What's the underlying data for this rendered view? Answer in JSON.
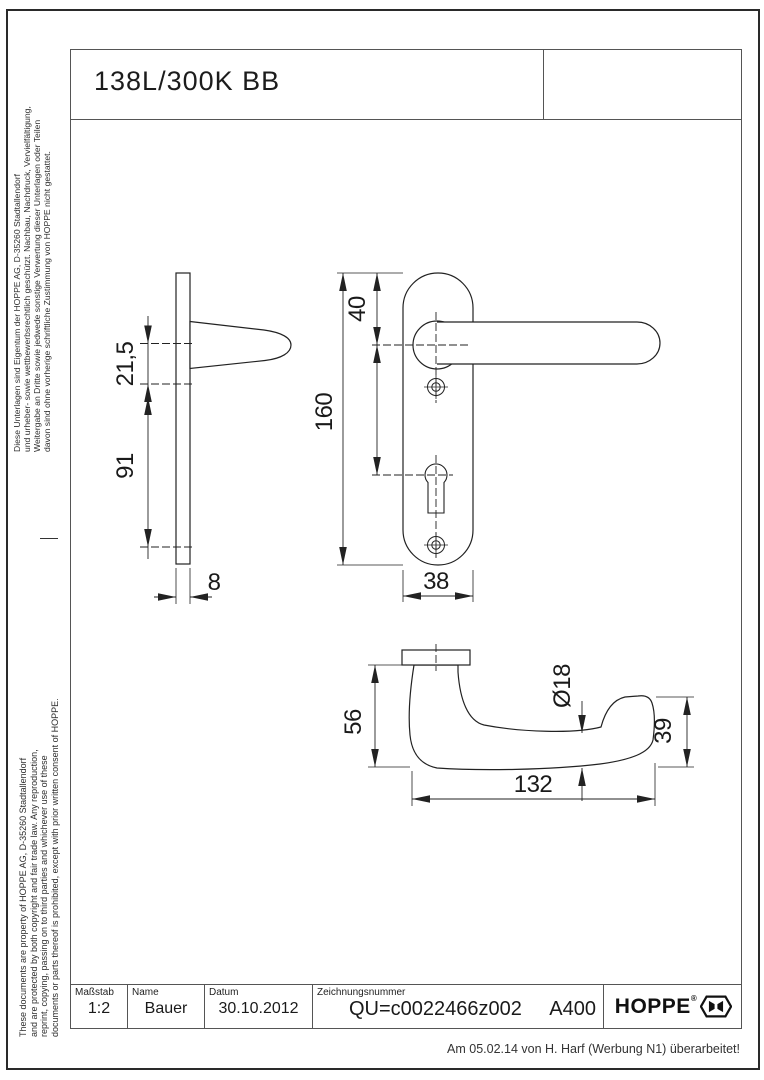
{
  "page": {
    "title": "138L/300K BB",
    "revision_note": "Am 05.02.14 von H. Harf (Werbung N1) überarbeitet!"
  },
  "legal": {
    "german": [
      "Diese Unterlagen sind Eigentum der HOPPE AG, D-35260 Stadtallendorf",
      "und urheber- sowie wettbewerbsrechtlich geschützt. Nachbau, Nachdruck, Vervielfältigung,",
      "Weitergabe an Dritte sowie jedwede sonstige Verwertung dieser Unterlagen oder Teilen",
      "davon sind ohne vorherige schriftliche Zustimmung von HOPPE nicht gestattet."
    ],
    "english": [
      "These documents are property of HOPPE AG, D-35260 Stadtallendorf",
      "and are protected by both copyright and fair trade law. Any reproduction,",
      "reprint, copying, passing on to third parties and whichever use of these",
      "documents or parts thereof is prohibited, except with prior written consent of HOPPE."
    ]
  },
  "title_block": {
    "scale_label": "Maßstab",
    "scale_value": "1:2",
    "name_label": "Name",
    "name_value": "Bauer",
    "date_label": "Datum",
    "date_value": "30.10.2012",
    "drawing_number_label": "Zeichnungsnummer",
    "drawing_number_value": "QU=c0022466z002",
    "format_value": "A400",
    "brand": "HOPPE",
    "registered_mark": "®"
  },
  "drawing": {
    "scale": "1:2",
    "dimensions": {
      "side": {
        "neck": "21,5",
        "lower": "91",
        "plate_thickness": "8"
      },
      "front": {
        "top_to_handle": "40",
        "plate_height": "160",
        "plate_width": "38"
      },
      "top": {
        "height": "56",
        "grip_diameter": "Ø18",
        "end_height": "39",
        "length": "132"
      }
    }
  },
  "colors": {
    "line": "#222222",
    "frame": "#555555",
    "text": "#1a1a1a"
  }
}
